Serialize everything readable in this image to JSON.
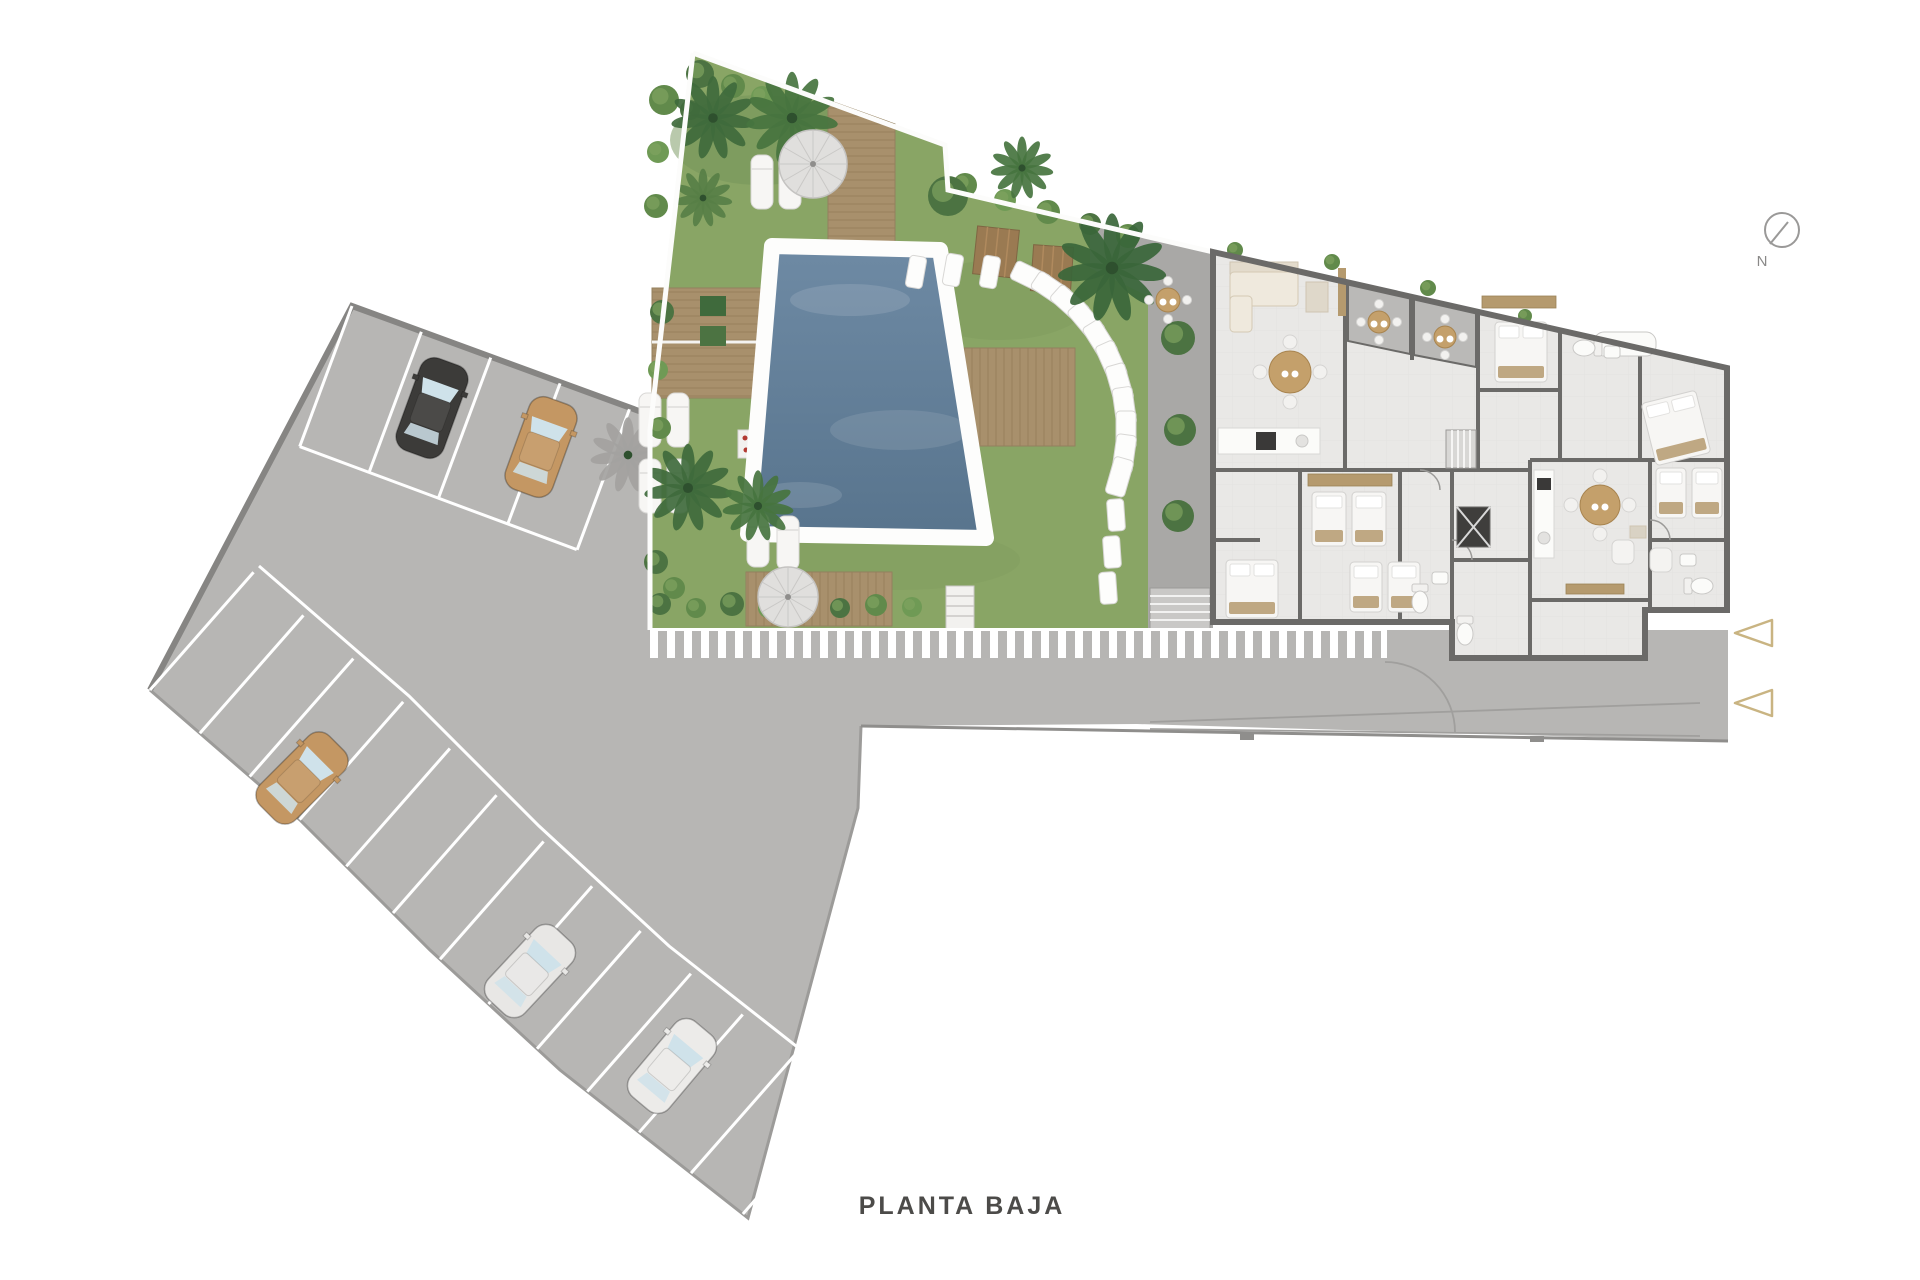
{
  "plan": {
    "title": "PLANTA BAJA",
    "compass_label": "N"
  },
  "colors": {
    "grass": "#89a565",
    "water": "#64809a",
    "wood": "#a8906c",
    "asphalt": "#b7b6b4",
    "wall": "#6b6a68",
    "floor": "#e9e8e6",
    "terrace": "#bab9b7",
    "band": "#b6b5b3",
    "entrance_arrow": "#c9b482",
    "title_text": "#4c4b49"
  },
  "site": {
    "parking": {
      "cars": [
        {
          "x": 432,
          "y": 408,
          "rot": 20,
          "c": "#3c3b39"
        },
        {
          "x": 541,
          "y": 447,
          "rot": 20,
          "c": "#c49763"
        },
        {
          "x": 302,
          "y": 778,
          "rot": 45,
          "c": "#c49763"
        },
        {
          "x": 530,
          "y": 971,
          "rot": 43,
          "c": "#e8e7e5"
        },
        {
          "x": 672,
          "y": 1066,
          "rot": 40,
          "c": "#ecebe9"
        }
      ]
    },
    "garden": {
      "palms": [
        {
          "x": 713,
          "y": 118,
          "r": 40,
          "c": "#3f6a3c"
        },
        {
          "x": 792,
          "y": 118,
          "r": 44,
          "c": "#46743f"
        },
        {
          "x": 703,
          "y": 198,
          "r": 28,
          "c": "#577f46"
        },
        {
          "x": 688,
          "y": 488,
          "r": 42,
          "c": "#3f6a3c"
        },
        {
          "x": 758,
          "y": 506,
          "r": 34,
          "c": "#46743f"
        },
        {
          "x": 1112,
          "y": 268,
          "r": 52,
          "c": "#3a663a"
        },
        {
          "x": 1022,
          "y": 168,
          "r": 30,
          "c": "#46743f"
        }
      ],
      "shadow_palm": {
        "x": 628,
        "y": 455,
        "r": 36,
        "c": "#a3a2a0"
      },
      "bushes": [
        {
          "x": 664,
          "y": 100,
          "r": 15,
          "c": "#618a4b"
        },
        {
          "x": 700,
          "y": 74,
          "r": 14,
          "c": "#4c7342"
        },
        {
          "x": 733,
          "y": 86,
          "r": 12,
          "c": "#618a4b"
        },
        {
          "x": 762,
          "y": 97,
          "r": 11,
          "c": "#6f9a55"
        },
        {
          "x": 690,
          "y": 110,
          "r": 10,
          "c": "#4c7342"
        },
        {
          "x": 658,
          "y": 152,
          "r": 11,
          "c": "#6f9a55"
        },
        {
          "x": 656,
          "y": 206,
          "r": 12,
          "c": "#618a4b"
        },
        {
          "x": 662,
          "y": 312,
          "r": 12,
          "c": "#4c7342"
        },
        {
          "x": 658,
          "y": 370,
          "r": 10,
          "c": "#6f9a55"
        },
        {
          "x": 660,
          "y": 428,
          "r": 11,
          "c": "#618a4b"
        },
        {
          "x": 656,
          "y": 562,
          "r": 12,
          "c": "#4c7342"
        },
        {
          "x": 674,
          "y": 588,
          "r": 11,
          "c": "#618a4b"
        },
        {
          "x": 660,
          "y": 604,
          "r": 11,
          "c": "#4c7342"
        },
        {
          "x": 696,
          "y": 608,
          "r": 10,
          "c": "#618a4b"
        },
        {
          "x": 732,
          "y": 604,
          "r": 12,
          "c": "#4c7342"
        },
        {
          "x": 768,
          "y": 608,
          "r": 10,
          "c": "#6f9a55"
        },
        {
          "x": 804,
          "y": 605,
          "r": 11,
          "c": "#618a4b"
        },
        {
          "x": 840,
          "y": 608,
          "r": 10,
          "c": "#4c7342"
        },
        {
          "x": 876,
          "y": 605,
          "r": 11,
          "c": "#618a4b"
        },
        {
          "x": 912,
          "y": 607,
          "r": 10,
          "c": "#6f9a55"
        },
        {
          "x": 965,
          "y": 185,
          "r": 12,
          "c": "#618a4b"
        },
        {
          "x": 1005,
          "y": 200,
          "r": 11,
          "c": "#6f9a55"
        },
        {
          "x": 1048,
          "y": 212,
          "r": 12,
          "c": "#618a4b"
        },
        {
          "x": 1090,
          "y": 224,
          "r": 11,
          "c": "#4c7342"
        },
        {
          "x": 1128,
          "y": 236,
          "r": 12,
          "c": "#618a4b"
        },
        {
          "x": 948,
          "y": 196,
          "r": 20,
          "c": "#4c7342"
        },
        {
          "x": 1178,
          "y": 338,
          "r": 17,
          "c": "#4c7342"
        },
        {
          "x": 1180,
          "y": 430,
          "r": 16,
          "c": "#4c7342"
        },
        {
          "x": 1178,
          "y": 516,
          "r": 16,
          "c": "#4c7342"
        },
        {
          "x": 1235,
          "y": 250,
          "r": 8,
          "c": "#618a4b"
        },
        {
          "x": 1332,
          "y": 262,
          "r": 8,
          "c": "#618a4b"
        },
        {
          "x": 1428,
          "y": 288,
          "r": 8,
          "c": "#618a4b"
        },
        {
          "x": 1525,
          "y": 316,
          "r": 7,
          "c": "#618a4b"
        },
        {
          "x": 1620,
          "y": 340,
          "r": 7,
          "c": "#618a4b"
        },
        {
          "x": 1714,
          "y": 440,
          "r": 9,
          "c": "#618a4b"
        },
        {
          "x": 1700,
          "y": 472,
          "r": 7,
          "c": "#6f9a55"
        }
      ],
      "stepping_stones": {
        "arc_center_x": 956,
        "arc_center_y": 430,
        "arc_radius": 170,
        "arc_start_deg": -64,
        "arc_end_deg": 16,
        "arc_step_deg": 8,
        "trail": [
          {
            "x": 1116,
            "y": 515
          },
          {
            "x": 1112,
            "y": 552
          },
          {
            "x": 1108,
            "y": 588
          }
        ],
        "lead": [
          {
            "x": 990,
            "y": 272
          },
          {
            "x": 953,
            "y": 270
          },
          {
            "x": 916,
            "y": 272
          }
        ]
      },
      "loungers": [
        {
          "x": 650,
          "y": 420
        },
        {
          "x": 678,
          "y": 420
        },
        {
          "x": 650,
          "y": 486
        },
        {
          "x": 678,
          "y": 486
        },
        {
          "x": 758,
          "y": 540
        },
        {
          "x": 788,
          "y": 543
        },
        {
          "x": 762,
          "y": 182
        },
        {
          "x": 790,
          "y": 182
        }
      ],
      "parasols": [
        {
          "x": 813,
          "y": 164,
          "r": 34
        },
        {
          "x": 788,
          "y": 597,
          "r": 30
        }
      ]
    },
    "building": {
      "beds": [
        {
          "x": 1495,
          "y": 322,
          "w": 52,
          "h": 60,
          "rot": 0
        },
        {
          "x": 1648,
          "y": 396,
          "w": 56,
          "h": 64,
          "rot": -14
        },
        {
          "x": 1312,
          "y": 492,
          "w": 34,
          "h": 54,
          "rot": 0
        },
        {
          "x": 1352,
          "y": 492,
          "w": 34,
          "h": 54,
          "rot": 0
        },
        {
          "x": 1226,
          "y": 560,
          "w": 52,
          "h": 58,
          "rot": 0
        },
        {
          "x": 1656,
          "y": 468,
          "w": 30,
          "h": 50,
          "rot": 0
        },
        {
          "x": 1692,
          "y": 468,
          "w": 30,
          "h": 50,
          "rot": 0
        },
        {
          "x": 1350,
          "y": 562,
          "w": 32,
          "h": 50,
          "rot": 0
        },
        {
          "x": 1388,
          "y": 562,
          "w": 32,
          "h": 50,
          "rot": 0
        }
      ],
      "tables": [
        {
          "x": 1290,
          "y": 372,
          "r": 21
        },
        {
          "x": 1600,
          "y": 505,
          "r": 20
        }
      ],
      "patio_tables": [
        {
          "x": 1379,
          "y": 322,
          "r": 11
        },
        {
          "x": 1445,
          "y": 337,
          "r": 11
        },
        {
          "x": 1168,
          "y": 300,
          "r": 12
        }
      ],
      "toilets": [
        {
          "x": 1420,
          "y": 600,
          "rot": 0
        },
        {
          "x": 1586,
          "y": 348,
          "rot": 90
        },
        {
          "x": 1700,
          "y": 586,
          "rot": -90
        },
        {
          "x": 1465,
          "y": 632,
          "rot": 0
        }
      ],
      "sinks": [
        {
          "x": 1440,
          "y": 578
        },
        {
          "x": 1612,
          "y": 352
        },
        {
          "x": 1688,
          "y": 560
        }
      ]
    }
  }
}
